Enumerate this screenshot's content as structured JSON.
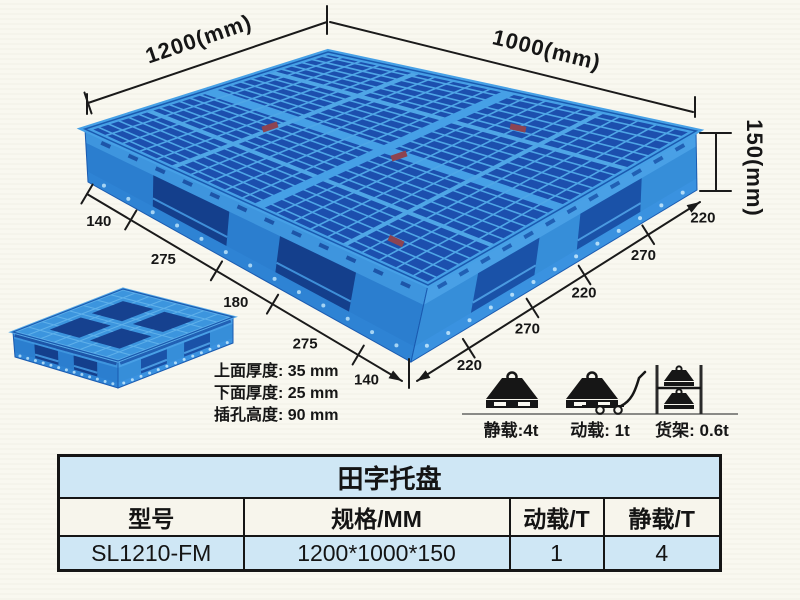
{
  "page": {
    "background": "#f9f8f0"
  },
  "drawing": {
    "length_label": "1200(mm)",
    "width_label": "1000(mm)",
    "height_label": "150(mm)",
    "bottom_left_segments": [
      "140",
      "275",
      "180",
      "275",
      "140"
    ],
    "bottom_right_segments": [
      "220",
      "270",
      "220",
      "270",
      "220"
    ],
    "thickness_notes": [
      "上面厚度: 35 mm",
      "下面厚度: 25 mm",
      "插孔高度: 90 mm"
    ],
    "load_ratings": [
      {
        "icon": "static-load-weight-icon",
        "label": "静载:4t"
      },
      {
        "icon": "dynamic-load-trolley-icon",
        "label": "动载: 1t"
      },
      {
        "icon": "rack-load-shelf-icon",
        "label": "货架: 0.6t"
      }
    ],
    "pallet_colors": {
      "surface_rib": "#4fa6e6",
      "surface_hole": "#1c4fae",
      "wall": "#2b7ecf",
      "fork_opening": "#143f8c"
    }
  },
  "spec_table": {
    "title": "田字托盘",
    "headers": [
      "型号",
      "规格/MM",
      "动载/T",
      "静载/T"
    ],
    "rows": [
      {
        "model": "SL1210-FM",
        "size": "1200*1000*150",
        "dynamic_load": "1",
        "static_load": "4"
      }
    ]
  }
}
